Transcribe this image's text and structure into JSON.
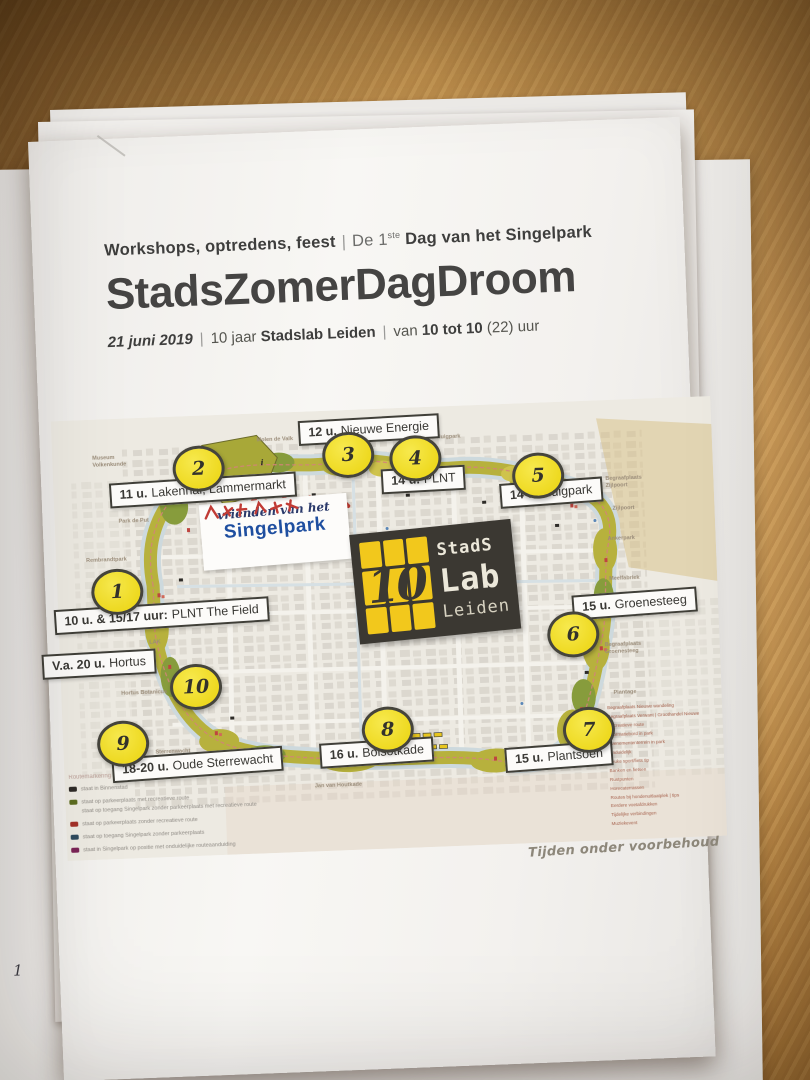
{
  "colors": {
    "wood": "#c08d49",
    "paper": "#f3f1ee",
    "circle_yellow": "#f2e02e",
    "circle_border": "#45443c",
    "park_green": "#b7b13d",
    "logo_blue": "#1f4fa0",
    "stadslab_yellow": "#f2c81c",
    "stadslab_bg": "#3b3832",
    "legend_marker_colors": [
      "#2f2b27",
      "#5d6d20",
      "#a33028",
      "#2f4b5e",
      "#7b2356"
    ]
  },
  "header": {
    "line1_left": "Workshops, optredens, feest",
    "line1_sep": "|",
    "line1_mid": "De 1",
    "line1_sup": "ste",
    "line1_right": "Dag van het Singelpark",
    "title": "StadsZomerDagDroom",
    "line2_date": "21 juni 2019",
    "line2_sep1": "|",
    "line2_mid1": "10 jaar",
    "line2_bold1": "Stadslab Leiden",
    "line2_sep2": "|",
    "line2_mid2": "van",
    "line2_bold2": "10 tot 10",
    "line2_tail": "(22) uur"
  },
  "map": {
    "info_marker": "i",
    "event_labels": [
      {
        "time": "12 u.",
        "place": "Nieuwe Energie"
      },
      {
        "time": "11 u.",
        "place": "Lakenhal, Lammermarkt"
      },
      {
        "time": "14 u.",
        "place": "PLNT"
      },
      {
        "time": "14 u.",
        "place": "Huigpark"
      },
      {
        "time": "10 u. & 15/17 uur:",
        "place": "PLNT The Field"
      },
      {
        "time": "V.a. 20 u.",
        "place": "Hortus"
      },
      {
        "time": "15 u.",
        "place": "Groenesteeg"
      },
      {
        "time": "18-20 u.",
        "place": "Oude Sterrewacht"
      },
      {
        "time": "16 u.",
        "place": "Boisotkade"
      },
      {
        "time": "15 u.",
        "place": "Plantsoen"
      }
    ],
    "markers": [
      "1",
      "2",
      "3",
      "4",
      "5",
      "6",
      "7",
      "8",
      "9",
      "10"
    ],
    "places": [
      "Molen de Valk",
      "Museum Volkenkunde",
      "Huigpark",
      "Park de Put",
      "Rembrandtpark",
      "LAK",
      "Hortus Botanicus",
      "Sterrenwacht",
      "Jan van Houtkade",
      "Begraafplaats Zijlpoort",
      "Zijlpoort",
      "Ankerpark",
      "Meelfabriek",
      "Begraafplaats Groenesteeg",
      "Plantage",
      "Het Plantsoen"
    ],
    "logo_singelpark": {
      "line1": "vrienden van het",
      "line2": "Singelpark"
    },
    "logo_stadslab": {
      "number": "10",
      "line1": "StadS",
      "line2": "Lab",
      "line3": "Leiden"
    },
    "legend": {
      "heading": "Routemarkering",
      "rows": [
        {
          "text": "staat in Binnenstad"
        },
        {
          "text": "staat op parkeerplaats met recreatieve route",
          "text2": "staat op toegang Singelpark zonder parkeerplaats met recreatieve route"
        },
        {
          "text": "staat op parkeerplaats zonder recreatieve route"
        },
        {
          "text": "staat op toegang Singelpark zonder parkeerplaats"
        },
        {
          "text": "staat in Singelpark op positie met onduidelijke routeaanduiding"
        }
      ]
    },
    "map_key_lines": [
      "Begraafplaats Nieuwe wandeling",
      "Begraafplaats Verwant | Groothandel Nieuwe",
      "Recreatieve route",
      "Informatiebord in park",
      "Evenemententerrein in park",
      "Onduidelijk",
      "Leuke sport/fiets tip",
      "Banken en fietsen",
      "Rustpunten",
      "Horecaterrassen",
      "Routes bij hondenuitlaatplek | tips",
      "Eerdere voetafdrukken",
      "Tijdelijke verbindingen",
      "Muziekevent"
    ],
    "footnote": "Tijden onder voorbehoud"
  },
  "page_number": "1"
}
